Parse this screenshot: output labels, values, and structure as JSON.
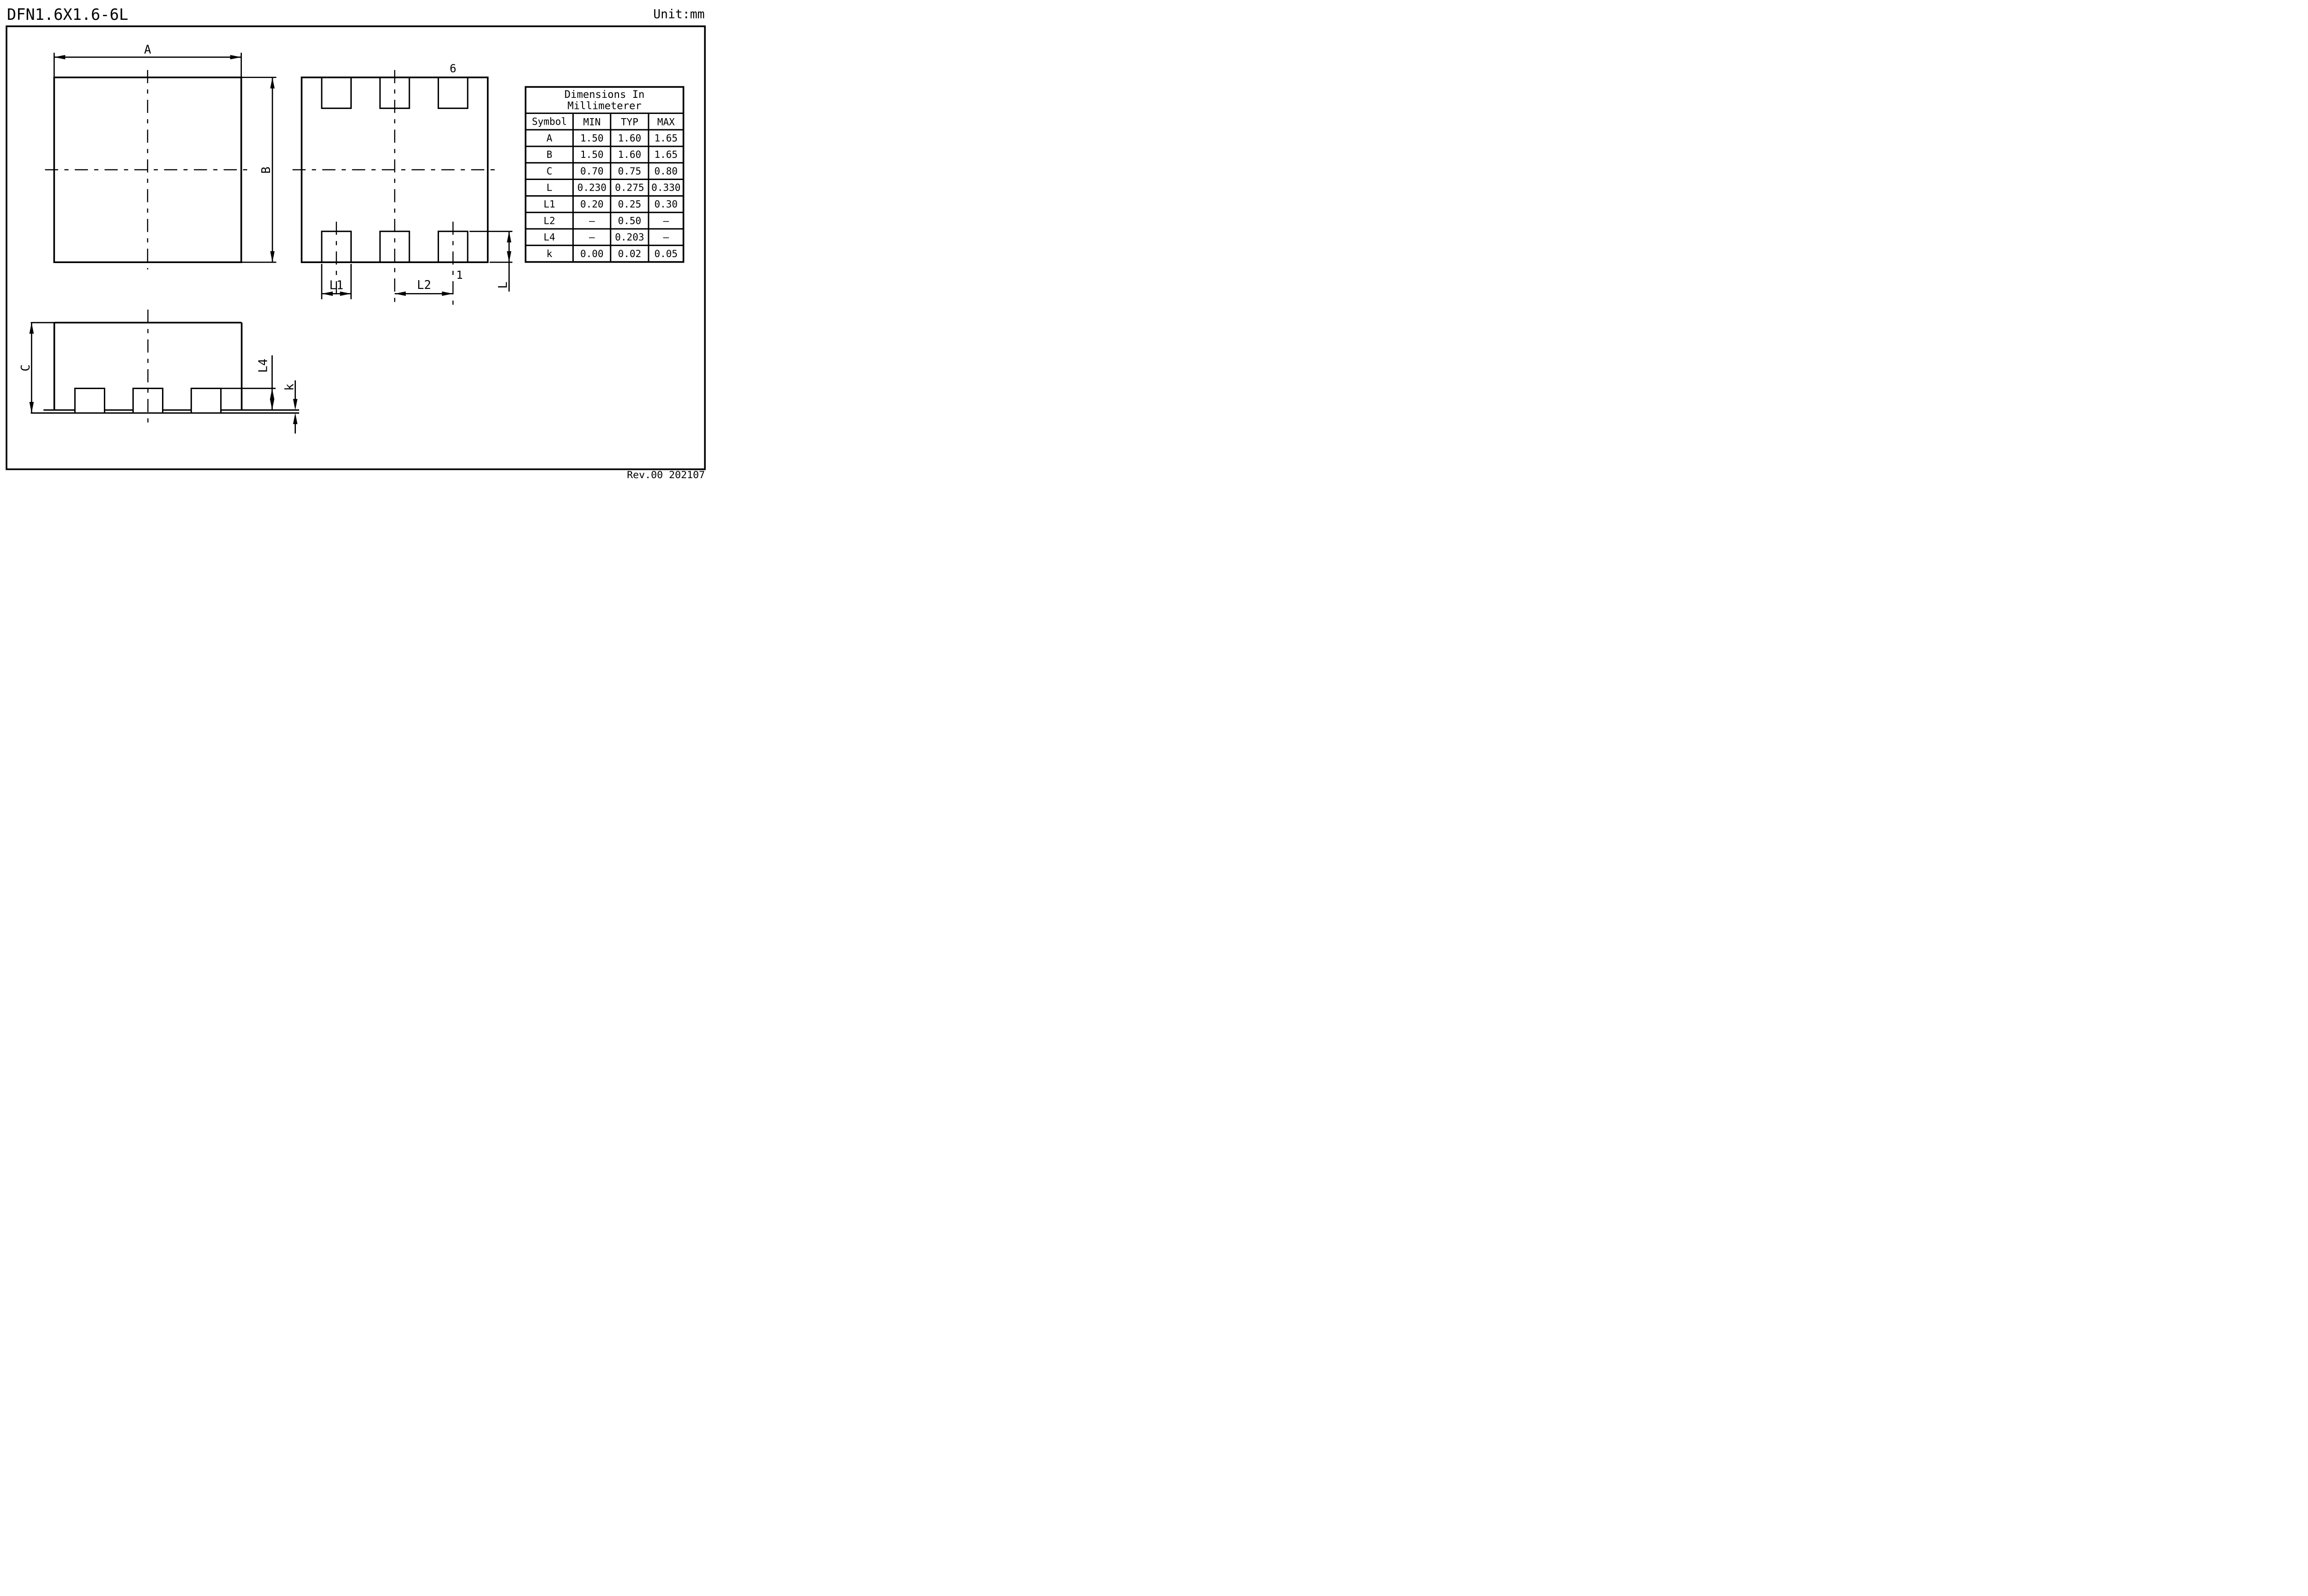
{
  "page": {
    "title": "DFN1.6X1.6-6L",
    "unit_label": "Unit:mm",
    "revision": "Rev.00 202107"
  },
  "drawing": {
    "labels": {
      "dim_a": "A",
      "dim_b": "B",
      "dim_c": "C",
      "dim_l": "L",
      "dim_l1": "L1",
      "dim_l2": "L2",
      "dim_l4": "L4",
      "dim_k": "k",
      "pin_6": "6",
      "pin_1": "1"
    }
  },
  "table": {
    "title_line1": "Dimensions In",
    "title_line2": "Millimeterer",
    "headers": {
      "symbol": "Symbol",
      "min": "MIN",
      "typ": "TYP",
      "max": "MAX"
    },
    "rows": [
      {
        "symbol": "A",
        "min": "1.50",
        "typ": "1.60",
        "max": "1.65"
      },
      {
        "symbol": "B",
        "min": "1.50",
        "typ": "1.60",
        "max": "1.65"
      },
      {
        "symbol": "C",
        "min": "0.70",
        "typ": "0.75",
        "max": "0.80"
      },
      {
        "symbol": "L",
        "min": "0.230",
        "typ": "0.275",
        "max": "0.330"
      },
      {
        "symbol": "L1",
        "min": "0.20",
        "typ": "0.25",
        "max": "0.30"
      },
      {
        "symbol": "L2",
        "min": "–",
        "typ": "0.50",
        "max": "–"
      },
      {
        "symbol": "L4",
        "min": "–",
        "typ": "0.203",
        "max": "–"
      },
      {
        "symbol": "k",
        "min": "0.00",
        "typ": "0.02",
        "max": "0.05"
      }
    ]
  },
  "colors": {
    "ink": "#000000",
    "paper": "#ffffff"
  }
}
